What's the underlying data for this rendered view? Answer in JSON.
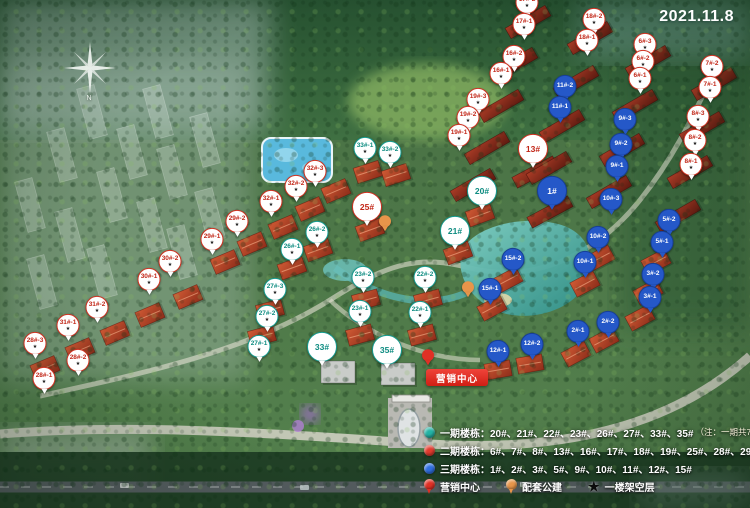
{
  "map": {
    "date": "2021.11.8",
    "compass_label": "N",
    "marketing_center": {
      "label": "营销中心"
    },
    "colors": {
      "phase1": "#1ca99b",
      "phase2": "#d63425",
      "phase3": "#2558c8",
      "marketing": "#e03025",
      "amenity": "#e8954a",
      "stilt_star": "#0c0c0c"
    },
    "markers": [
      {
        "t": "p2",
        "label": "17#-2",
        "x": 527,
        "y": 8,
        "star": true
      },
      {
        "t": "p2",
        "label": "17#-1",
        "x": 524,
        "y": 30,
        "star": true
      },
      {
        "t": "p2",
        "label": "16#-2",
        "x": 514,
        "y": 62,
        "star": true
      },
      {
        "t": "p2",
        "label": "16#-1",
        "x": 501,
        "y": 79,
        "star": true
      },
      {
        "t": "p2",
        "label": "19#-3",
        "x": 478,
        "y": 105,
        "star": true
      },
      {
        "t": "p2",
        "label": "19#-2",
        "x": 468,
        "y": 123,
        "star": true
      },
      {
        "t": "p2",
        "label": "19#-1",
        "x": 459,
        "y": 141,
        "star": true
      },
      {
        "t": "p2",
        "label": "18#-2",
        "x": 594,
        "y": 25,
        "star": true
      },
      {
        "t": "p2",
        "label": "18#-1",
        "x": 587,
        "y": 46,
        "star": true
      },
      {
        "t": "p2",
        "label": "6#-3",
        "x": 645,
        "y": 50,
        "star": true
      },
      {
        "t": "p2",
        "label": "6#-2",
        "x": 643,
        "y": 67,
        "star": true
      },
      {
        "t": "p2",
        "label": "6#-1",
        "x": 640,
        "y": 84,
        "star": true
      },
      {
        "t": "p2",
        "label": "7#-2",
        "x": 712,
        "y": 72,
        "star": true
      },
      {
        "t": "p2",
        "label": "7#-1",
        "x": 710,
        "y": 93,
        "star": true
      },
      {
        "t": "p2",
        "label": "8#-3",
        "x": 698,
        "y": 122,
        "star": true
      },
      {
        "t": "p2",
        "label": "8#-2",
        "x": 695,
        "y": 146,
        "star": true
      },
      {
        "t": "p2",
        "label": "8#-1",
        "x": 691,
        "y": 170,
        "star": true
      },
      {
        "t": "p2",
        "label": "32#-3",
        "x": 315,
        "y": 177,
        "star": true
      },
      {
        "t": "p2",
        "label": "32#-2",
        "x": 296,
        "y": 192,
        "star": true
      },
      {
        "t": "p2",
        "label": "32#-1",
        "x": 271,
        "y": 207,
        "star": true
      },
      {
        "t": "p2",
        "label": "29#-2",
        "x": 237,
        "y": 227,
        "star": true
      },
      {
        "t": "p2",
        "label": "29#-1",
        "x": 212,
        "y": 245,
        "star": true
      },
      {
        "t": "p2",
        "label": "30#-2",
        "x": 170,
        "y": 267,
        "star": true
      },
      {
        "t": "p2",
        "label": "30#-1",
        "x": 149,
        "y": 285,
        "star": true
      },
      {
        "t": "p2",
        "label": "31#-2",
        "x": 97,
        "y": 313,
        "star": true
      },
      {
        "t": "p2",
        "label": "31#-1",
        "x": 68,
        "y": 331,
        "star": true
      },
      {
        "t": "p2",
        "label": "28#-3",
        "x": 35,
        "y": 349,
        "star": true
      },
      {
        "t": "p2",
        "label": "28#-2",
        "x": 78,
        "y": 366,
        "star": true
      },
      {
        "t": "p2",
        "label": "28#-1",
        "x": 44,
        "y": 384,
        "star": true
      },
      {
        "t": "p2",
        "label": "25#",
        "x": 367,
        "y": 213,
        "big": true
      },
      {
        "t": "p2",
        "label": "13#",
        "x": 533,
        "y": 155,
        "big": true
      },
      {
        "t": "p1",
        "label": "33#-1",
        "x": 365,
        "y": 154,
        "star": true
      },
      {
        "t": "p1",
        "label": "33#-2",
        "x": 390,
        "y": 158,
        "star": true
      },
      {
        "t": "p1",
        "label": "20#",
        "x": 482,
        "y": 197,
        "big": true
      },
      {
        "t": "p1",
        "label": "21#",
        "x": 455,
        "y": 237,
        "big": true
      },
      {
        "t": "p1",
        "label": "22#-2",
        "x": 425,
        "y": 283,
        "star": true
      },
      {
        "t": "p1",
        "label": "22#-1",
        "x": 420,
        "y": 318,
        "star": true
      },
      {
        "t": "p1",
        "label": "23#-2",
        "x": 363,
        "y": 283,
        "star": true
      },
      {
        "t": "p1",
        "label": "23#-1",
        "x": 360,
        "y": 317,
        "star": true
      },
      {
        "t": "p1",
        "label": "26#-2",
        "x": 317,
        "y": 238,
        "star": true
      },
      {
        "t": "p1",
        "label": "26#-1",
        "x": 292,
        "y": 255,
        "star": true
      },
      {
        "t": "p1",
        "label": "27#-3",
        "x": 275,
        "y": 295,
        "star": true
      },
      {
        "t": "p1",
        "label": "27#-2",
        "x": 267,
        "y": 322,
        "star": true
      },
      {
        "t": "p1",
        "label": "27#-1",
        "x": 259,
        "y": 352,
        "star": true
      },
      {
        "t": "p1",
        "label": "33#",
        "x": 322,
        "y": 353,
        "big": true
      },
      {
        "t": "p1",
        "label": "35#",
        "x": 387,
        "y": 356,
        "big": true
      },
      {
        "t": "p3",
        "label": "11#-2",
        "x": 565,
        "y": 92
      },
      {
        "t": "p3",
        "label": "11#-1",
        "x": 560,
        "y": 113
      },
      {
        "t": "p3",
        "label": "1#",
        "x": 552,
        "y": 197,
        "big": true
      },
      {
        "t": "p3",
        "label": "15#-2",
        "x": 513,
        "y": 265
      },
      {
        "t": "p3",
        "label": "15#-1",
        "x": 490,
        "y": 295
      },
      {
        "t": "p3",
        "label": "9#-3",
        "x": 625,
        "y": 125
      },
      {
        "t": "p3",
        "label": "9#-2",
        "x": 621,
        "y": 150
      },
      {
        "t": "p3",
        "label": "9#-1",
        "x": 617,
        "y": 172
      },
      {
        "t": "p3",
        "label": "10#-3",
        "x": 611,
        "y": 205
      },
      {
        "t": "p3",
        "label": "10#-2",
        "x": 598,
        "y": 243
      },
      {
        "t": "p3",
        "label": "10#-1",
        "x": 585,
        "y": 268
      },
      {
        "t": "p3",
        "label": "5#-2",
        "x": 669,
        "y": 226
      },
      {
        "t": "p3",
        "label": "5#-1",
        "x": 662,
        "y": 248
      },
      {
        "t": "p3",
        "label": "3#-2",
        "x": 653,
        "y": 280
      },
      {
        "t": "p3",
        "label": "3#-1",
        "x": 650,
        "y": 303
      },
      {
        "t": "p3",
        "label": "2#-2",
        "x": 608,
        "y": 328
      },
      {
        "t": "p3",
        "label": "2#-1",
        "x": 578,
        "y": 337
      },
      {
        "t": "p3",
        "label": "12#-2",
        "x": 532,
        "y": 350
      },
      {
        "t": "p3",
        "label": "12#-1",
        "x": 498,
        "y": 357
      },
      {
        "t": "amen",
        "label": "",
        "x": 468,
        "y": 292
      },
      {
        "t": "amen",
        "label": "",
        "x": 385,
        "y": 226
      },
      {
        "t": "mktpin",
        "label": "",
        "x": 428,
        "y": 360
      }
    ]
  },
  "legend": {
    "rows": [
      {
        "label": "一期楼栋：",
        "value": "20#、21#、22#、23#、26#、27#、33#、35#",
        "note": "（注：一期共7栋楼180套住宅）"
      },
      {
        "label": "二期楼栋：",
        "value": "6#、7#、8#、13#、16#、17#、18#、19#、25#、28#、29#、30#、31#、32#",
        "note": ""
      },
      {
        "label": "三期楼栋：",
        "value": "1#、2#、3#、5#、9#、10#、11#、12#、15#",
        "note": ""
      }
    ],
    "items": [
      {
        "label": "营销中心"
      },
      {
        "label": "配套公建"
      },
      {
        "label": "一楼架空层",
        "icon_char": "★"
      }
    ]
  }
}
